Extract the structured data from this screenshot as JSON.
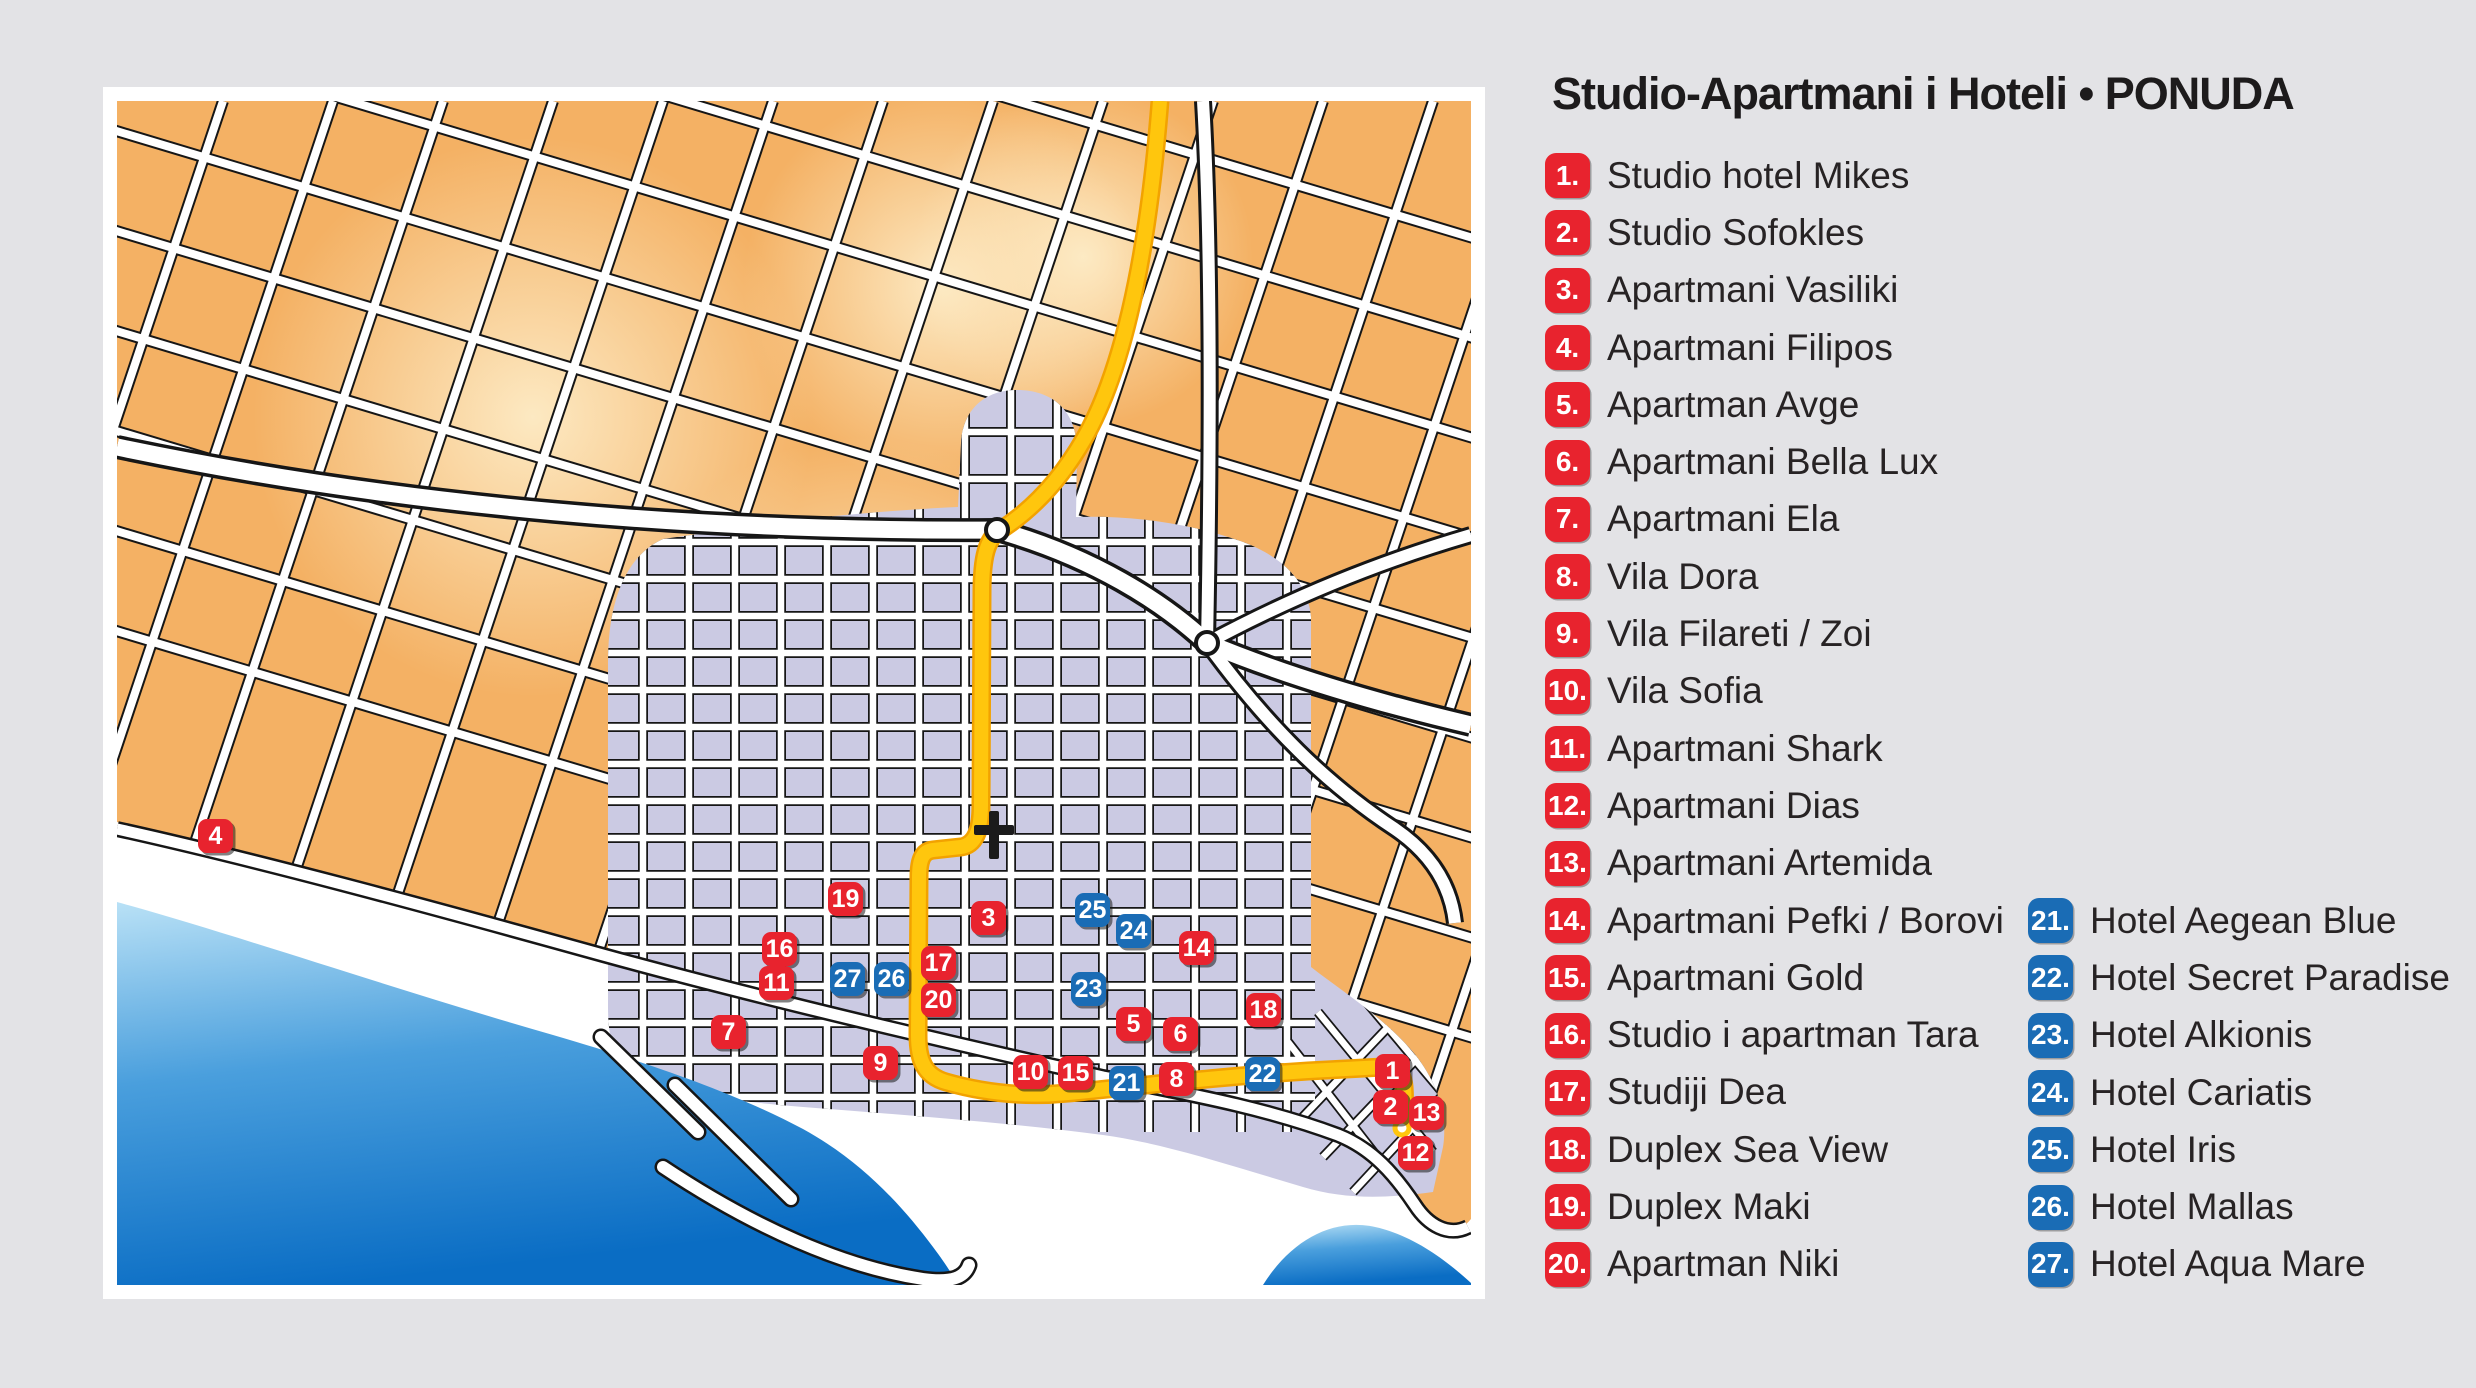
{
  "legend": {
    "title": "Studio-Apartmani i Hoteli • PONUDA",
    "items": [
      {
        "number": "1",
        "label": "Studio hotel Mikes",
        "type": "red"
      },
      {
        "number": "2",
        "label": "Studio Sofokles",
        "type": "red"
      },
      {
        "number": "3",
        "label": "Apartmani Vasiliki",
        "type": "red"
      },
      {
        "number": "4",
        "label": "Apartmani Filipos",
        "type": "red"
      },
      {
        "number": "5",
        "label": "Apartman Avge",
        "type": "red"
      },
      {
        "number": "6",
        "label": "Apartmani Bella Lux",
        "type": "red"
      },
      {
        "number": "7",
        "label": "Apartmani Ela",
        "type": "red"
      },
      {
        "number": "8",
        "label": "Vila Dora",
        "type": "red"
      },
      {
        "number": "9",
        "label": "Vila Filareti / Zoi",
        "type": "red"
      },
      {
        "number": "10",
        "label": "Vila Sofia",
        "type": "red"
      },
      {
        "number": "11",
        "label": "Apartmani Shark",
        "type": "red"
      },
      {
        "number": "12",
        "label": "Apartmani Dias",
        "type": "red"
      },
      {
        "number": "13",
        "label": "Apartmani Artemida",
        "type": "red"
      },
      {
        "number": "14",
        "label": "Apartmani Pefki / Borovi",
        "type": "red"
      },
      {
        "number": "15",
        "label": "Apartmani Gold",
        "type": "red"
      },
      {
        "number": "16",
        "label": "Studio i apartman Tara",
        "type": "red"
      },
      {
        "number": "17",
        "label": "Studiji Dea",
        "type": "red"
      },
      {
        "number": "18",
        "label": "Duplex Sea View",
        "type": "red"
      },
      {
        "number": "19",
        "label": "Duplex Maki",
        "type": "red"
      },
      {
        "number": "20",
        "label": "Apartman Niki",
        "type": "red"
      },
      {
        "number": "21",
        "label": "Hotel Aegean Blue",
        "type": "blue"
      },
      {
        "number": "22",
        "label": "Hotel Secret Paradise",
        "type": "blue"
      },
      {
        "number": "23",
        "label": "Hotel Alkionis",
        "type": "blue"
      },
      {
        "number": "24",
        "label": "Hotel Cariatis",
        "type": "blue"
      },
      {
        "number": "25",
        "label": "Hotel Iris",
        "type": "blue"
      },
      {
        "number": "26",
        "label": "Hotel Mallas",
        "type": "blue"
      },
      {
        "number": "27",
        "label": "Hotel Aqua Mare",
        "type": "blue"
      }
    ],
    "left_column_count": 20
  },
  "map": {
    "features": {
      "church": "latin-cross",
      "roundabouts": 2,
      "main_road": "yellow route ending at harbor dot"
    },
    "colors": {
      "background": "#e3e3e6",
      "card": "#ffffff",
      "land": "#f4b164",
      "land_glow": "#fce6bc",
      "town": "#cbcae3",
      "sea_deep": "#0a6dc4",
      "sea_shallow": "#b9e1f6",
      "road_yellow": "#ffc60d",
      "marker_red": "#e8232e",
      "marker_blue": "#1a6cb5"
    },
    "markers": [
      {
        "number": "4",
        "type": "red",
        "x": 112,
        "y": 749
      },
      {
        "number": "19",
        "type": "red",
        "x": 742,
        "y": 812
      },
      {
        "number": "3",
        "type": "red",
        "x": 885,
        "y": 831
      },
      {
        "number": "25",
        "type": "blue",
        "x": 989,
        "y": 823
      },
      {
        "number": "24",
        "type": "blue",
        "x": 1030,
        "y": 844
      },
      {
        "number": "14",
        "type": "red",
        "x": 1093,
        "y": 861
      },
      {
        "number": "16",
        "type": "red",
        "x": 676,
        "y": 862
      },
      {
        "number": "17",
        "type": "red",
        "x": 835,
        "y": 876
      },
      {
        "number": "27",
        "type": "blue",
        "x": 744,
        "y": 892
      },
      {
        "number": "26",
        "type": "blue",
        "x": 788,
        "y": 892
      },
      {
        "number": "11",
        "type": "red",
        "x": 673,
        "y": 896
      },
      {
        "number": "23",
        "type": "blue",
        "x": 985,
        "y": 902
      },
      {
        "number": "20",
        "type": "red",
        "x": 835,
        "y": 913
      },
      {
        "number": "18",
        "type": "red",
        "x": 1160,
        "y": 923
      },
      {
        "number": "5",
        "type": "red",
        "x": 1030,
        "y": 937
      },
      {
        "number": "7",
        "type": "red",
        "x": 625,
        "y": 945
      },
      {
        "number": "6",
        "type": "red",
        "x": 1077,
        "y": 947
      },
      {
        "number": "9",
        "type": "red",
        "x": 777,
        "y": 976
      },
      {
        "number": "10",
        "type": "red",
        "x": 927,
        "y": 985
      },
      {
        "number": "15",
        "type": "red",
        "x": 972,
        "y": 986
      },
      {
        "number": "22",
        "type": "blue",
        "x": 1159,
        "y": 987
      },
      {
        "number": "21",
        "type": "blue",
        "x": 1023,
        "y": 996
      },
      {
        "number": "8",
        "type": "red",
        "x": 1073,
        "y": 992
      },
      {
        "number": "1",
        "type": "red",
        "x": 1289,
        "y": 984
      },
      {
        "number": "2",
        "type": "red",
        "x": 1287,
        "y": 1020
      },
      {
        "number": "13",
        "type": "red",
        "x": 1323,
        "y": 1026
      },
      {
        "number": "12",
        "type": "red",
        "x": 1312,
        "y": 1066
      }
    ]
  }
}
